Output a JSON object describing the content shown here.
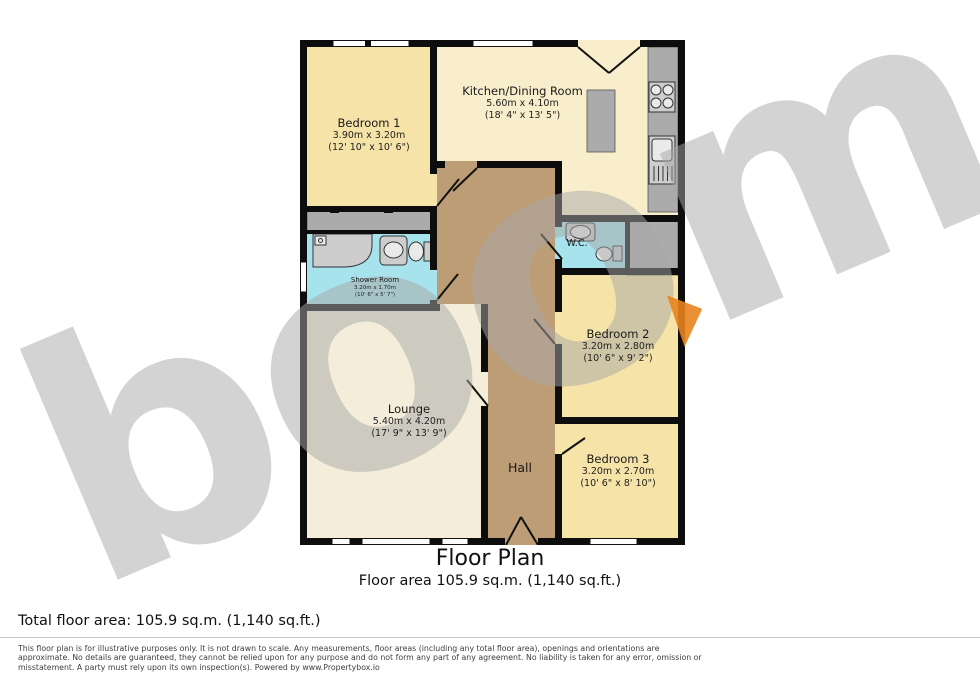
{
  "colors": {
    "wall": "#0d0d0d",
    "cream": "#f5e3a7",
    "cream_light": "#f8eecc",
    "lounge": "#f3edda",
    "wet": "#a7e3ec",
    "hall": "#bd9d76",
    "counter": "#ababab",
    "watermark": "#a8a8a8",
    "accent": "#e8831d"
  },
  "watermark": {
    "text": "boom"
  },
  "plan": {
    "rooms": [
      {
        "id": "bedroom1",
        "name": "Bedroom 1",
        "dims_metric": "3.90m x 3.20m",
        "dims_imperial": "(12' 10\" x 10' 6\")"
      },
      {
        "id": "kitchen",
        "name": "Kitchen/Dining Room",
        "dims_metric": "5.60m x 4.10m",
        "dims_imperial": "(18' 4\" x 13' 5\")"
      },
      {
        "id": "shower",
        "name": "Shower Room",
        "dims_metric": "3.20m x 1.70m",
        "dims_imperial": "(10' 6\" x 5' 7\")"
      },
      {
        "id": "wc",
        "name": "W.C."
      },
      {
        "id": "bedroom2",
        "name": "Bedroom 2",
        "dims_metric": "3.20m x 2.80m",
        "dims_imperial": "(10' 6\" x 9' 2\")"
      },
      {
        "id": "bedroom3",
        "name": "Bedroom 3",
        "dims_metric": "3.20m x 2.70m",
        "dims_imperial": "(10' 6\" x 8' 10\")"
      },
      {
        "id": "lounge",
        "name": "Lounge",
        "dims_metric": "5.40m x 4.20m",
        "dims_imperial": "(17' 9\" x 13' 9\")"
      },
      {
        "id": "hall",
        "name": "Hall"
      }
    ]
  },
  "title": {
    "heading": "Floor Plan",
    "subheading": "Floor area 105.9 sq.m. (1,140 sq.ft.)"
  },
  "footer": {
    "total_area": "Total floor area: 105.9 sq.m. (1,140 sq.ft.)",
    "disclaimer_lines": [
      "This floor plan is for illustrative purposes only. It is not drawn to scale. Any measurements, floor areas (including any total floor area), openings and orientations are",
      "approximate. No details are guaranteed, they cannot be relied upon for any purpose and do not form any part of any agreement. No liability is taken for any error, omission or",
      "misstatement. A party must rely upon its own inspection(s). Powered by www.Propertybox.io"
    ]
  }
}
